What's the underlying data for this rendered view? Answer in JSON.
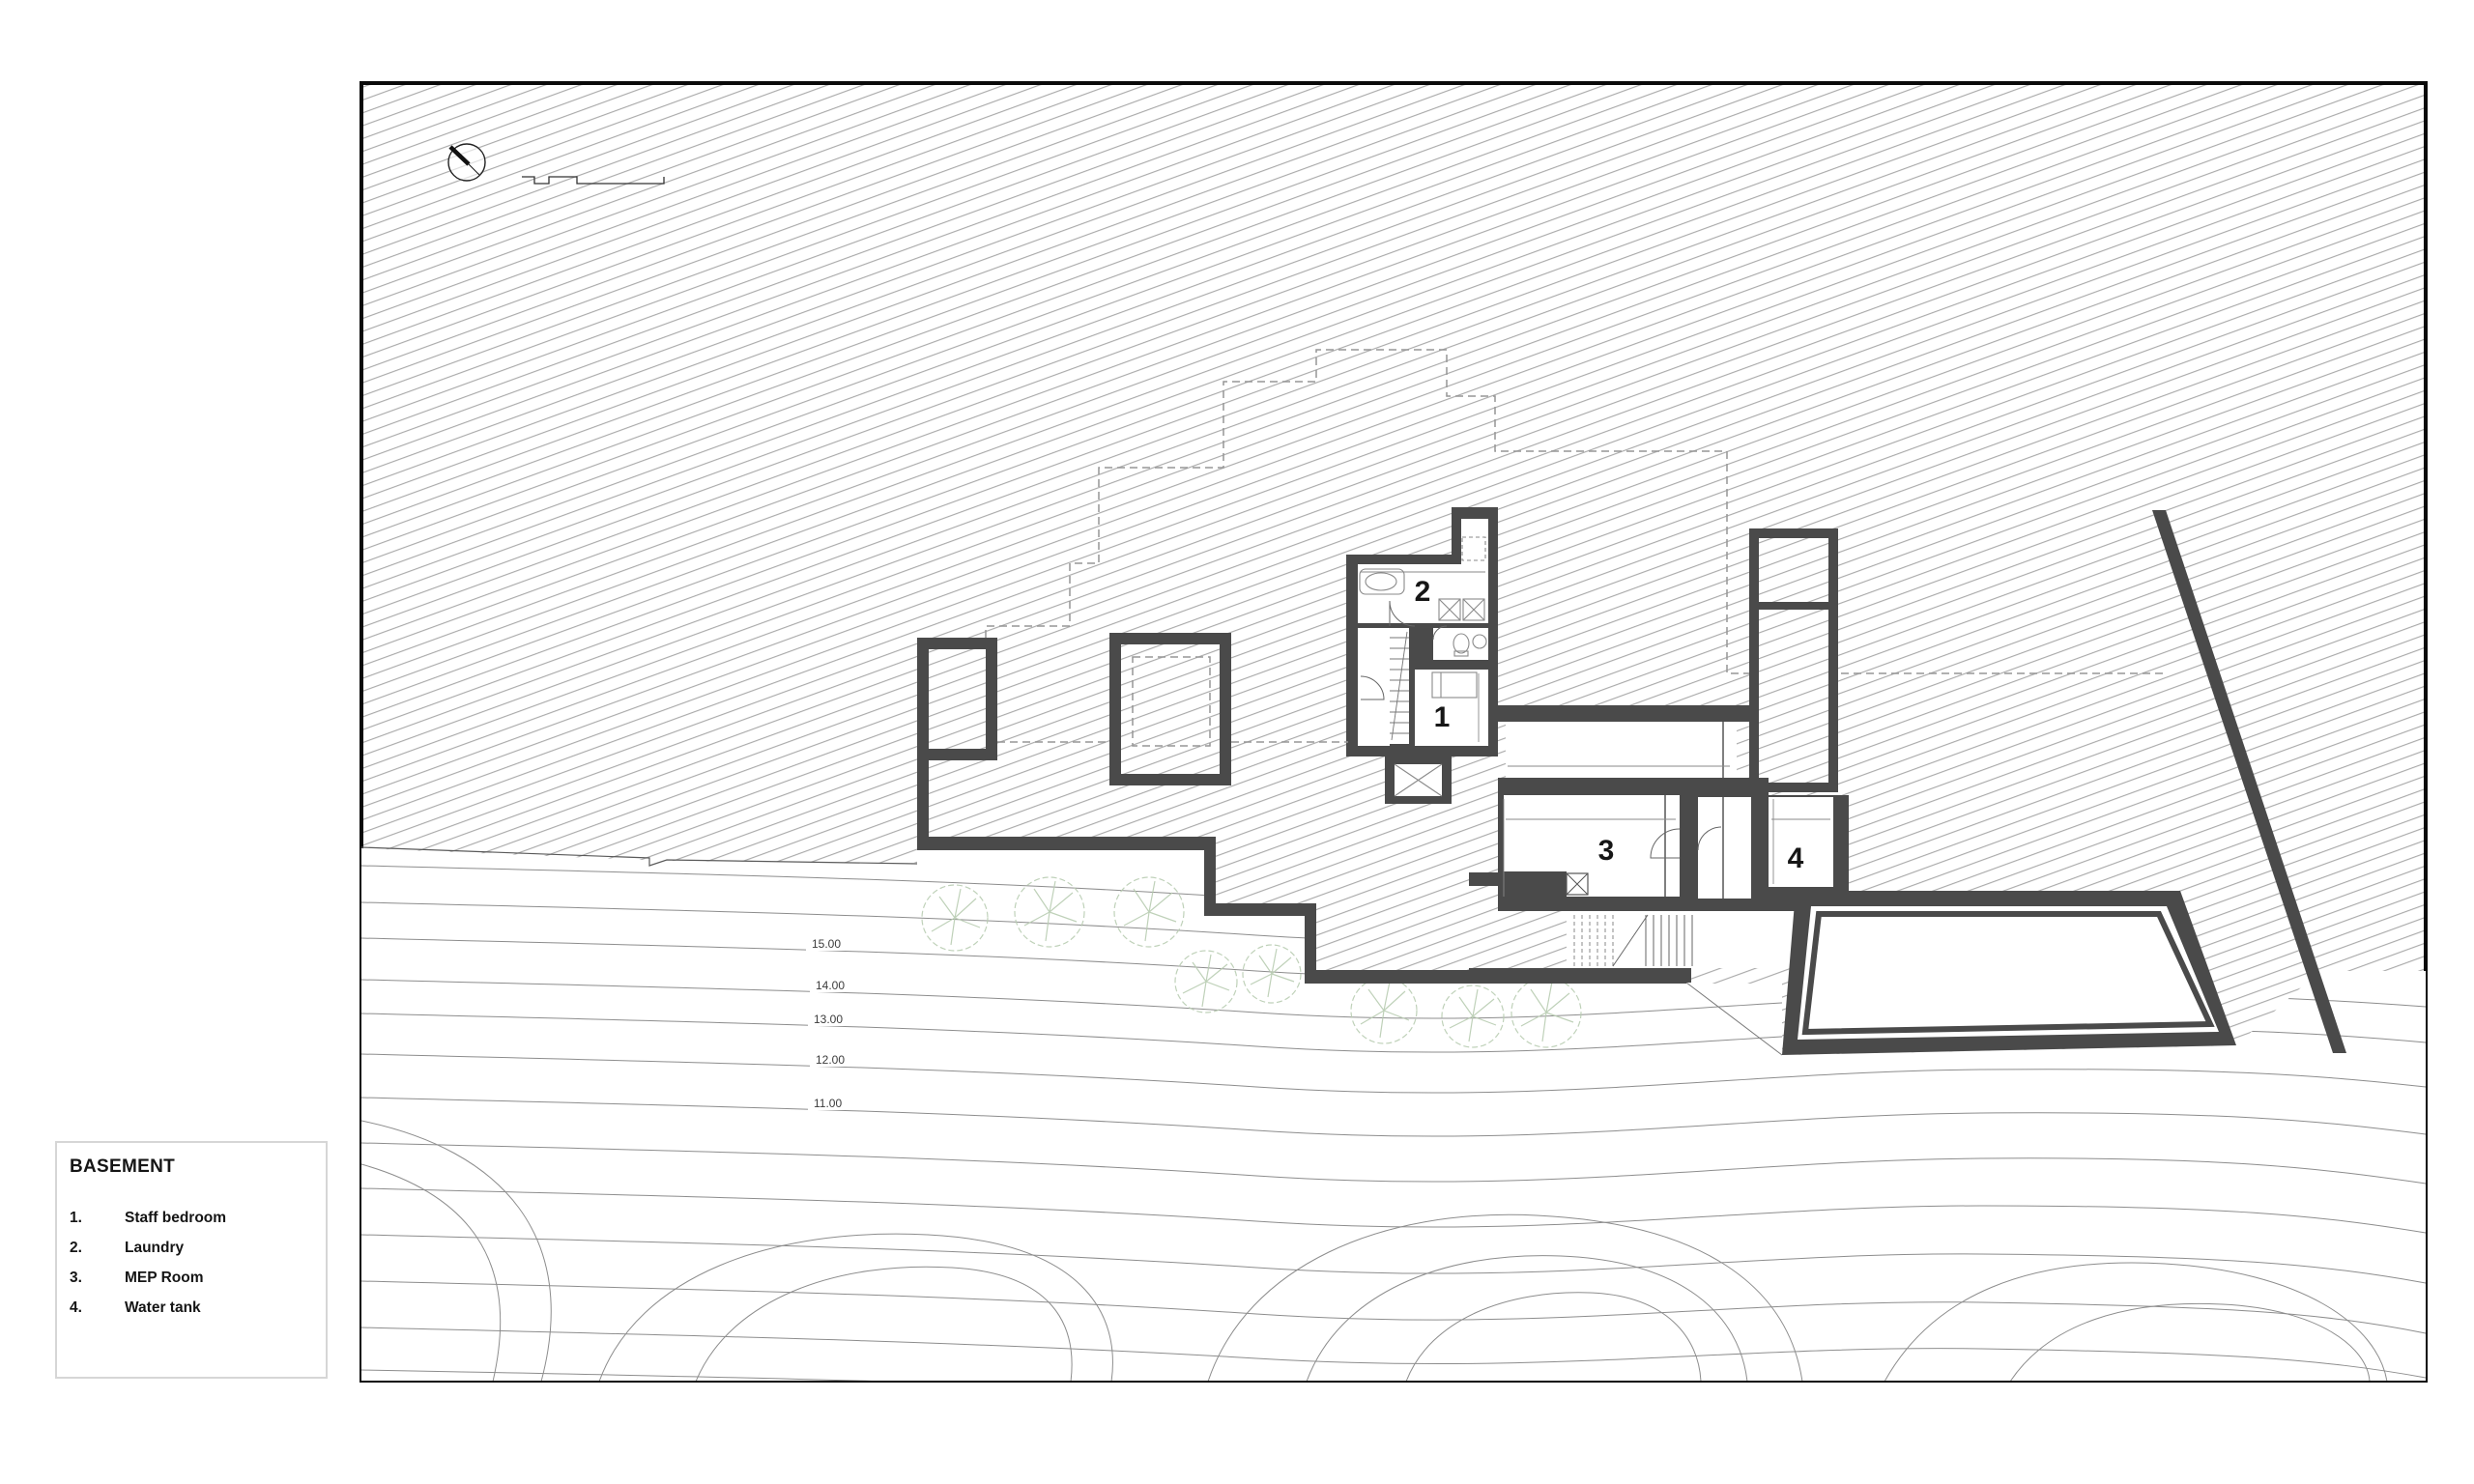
{
  "legend": {
    "title": "BASEMENT",
    "items": [
      {
        "num": "1.",
        "label": "Staff bedroom"
      },
      {
        "num": "2.",
        "label": "Laundry"
      },
      {
        "num": "3.",
        "label": "MEP Room"
      },
      {
        "num": "4.",
        "label": "Water tank"
      }
    ]
  },
  "plan": {
    "room_numbers": [
      "1",
      "2",
      "3",
      "4"
    ],
    "contour_labels": [
      "15.00",
      "14.00",
      "13.00",
      "12.00",
      "11.00"
    ]
  },
  "icons": {
    "north_arrow": "north-arrow",
    "scale_bar": "scale-bar"
  },
  "colors": {
    "wall": "#4a4a4a",
    "hatch": "#a6a6a6",
    "contour": "#8d8d8d",
    "tree": "#b9cdb2",
    "frame": "#0a0a0a"
  }
}
